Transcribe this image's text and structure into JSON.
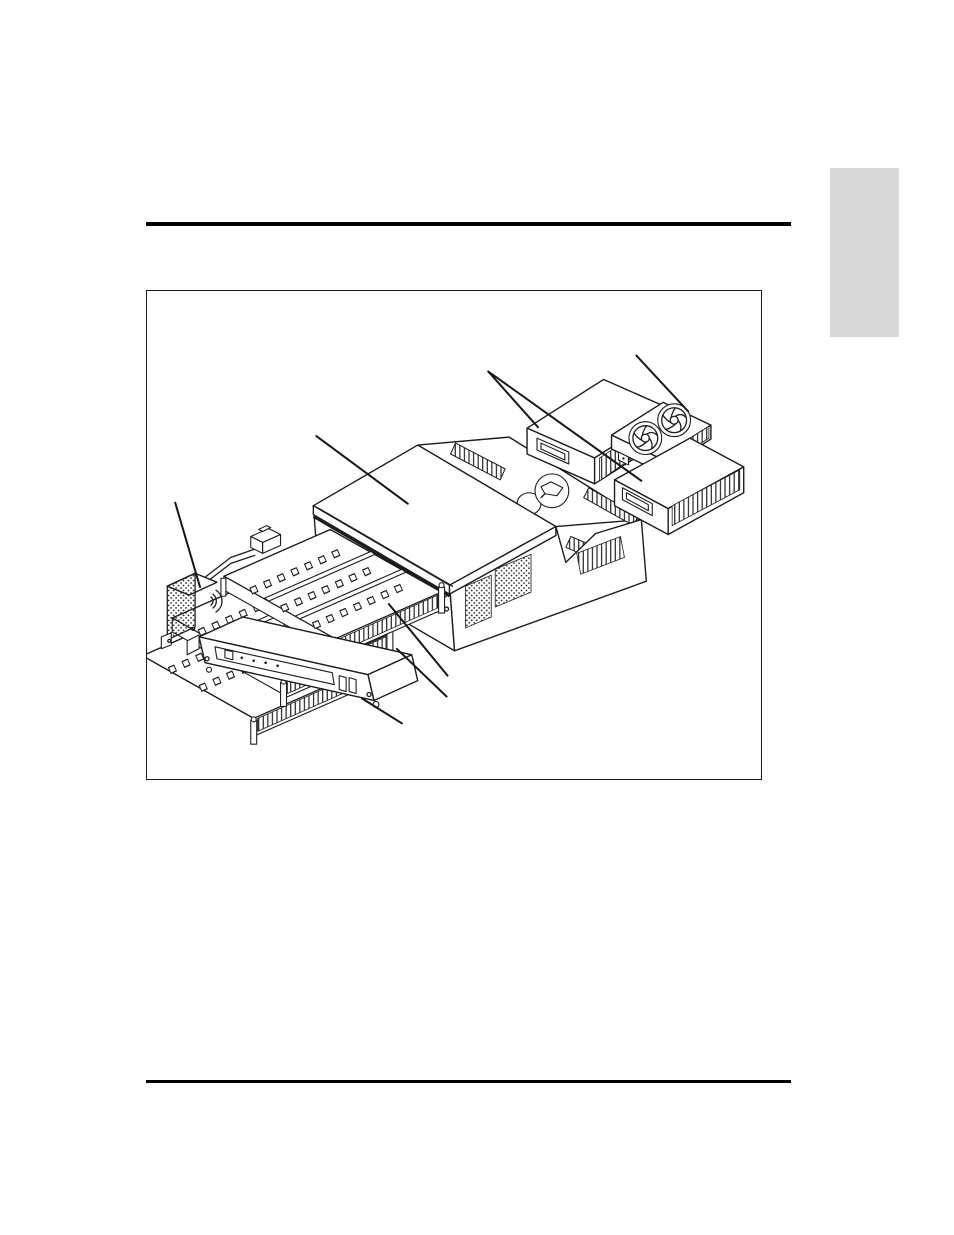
{
  "document": {
    "page_background": "#ffffff",
    "contains_text": false
  },
  "decor": {
    "top_rule": {
      "color": "#000000",
      "thickness_px": 4
    },
    "bottom_rule": {
      "color": "#000000",
      "thickness_px": 2.5
    },
    "chapter_tab": {
      "color": "#d8d8d8"
    }
  },
  "figure": {
    "frame_border_color": "#1a1a1a",
    "illustration": {
      "kind": "isometric-exploded-line-drawing",
      "line_color": "#1c1c1c",
      "fill_color": "#ffffff",
      "components": [
        {
          "name": "top-cover"
        },
        {
          "name": "main-chassis"
        },
        {
          "name": "chassis-fan-openings",
          "count": 2
        },
        {
          "name": "power-supply-module-upper"
        },
        {
          "name": "dual-fan-module",
          "fan_count": 2
        },
        {
          "name": "power-supply-module-lower"
        },
        {
          "name": "left-power-module"
        },
        {
          "name": "card-cage-tray",
          "count": 3
        },
        {
          "name": "bottom-tray"
        }
      ],
      "leader_line_count": 8
    }
  }
}
